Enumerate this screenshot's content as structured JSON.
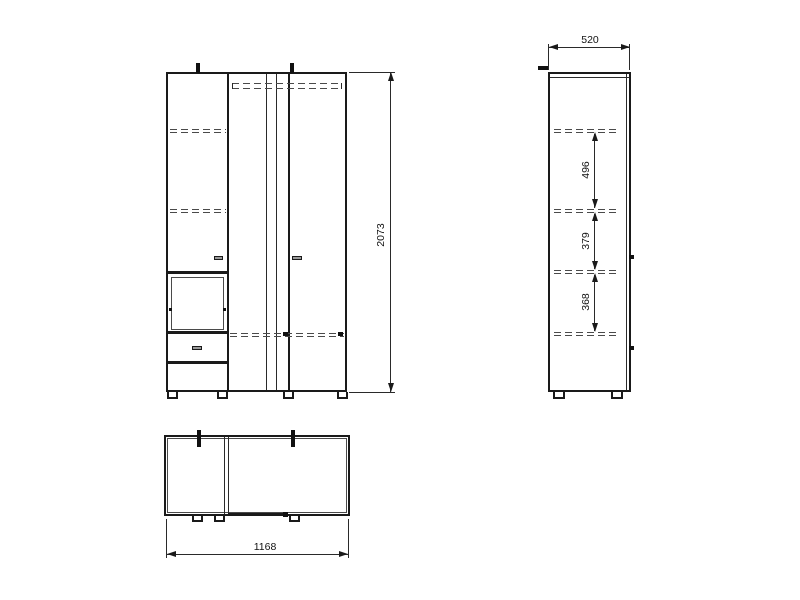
{
  "drawing": {
    "front": {
      "height_mm": "2073"
    },
    "side": {
      "depth_mm": "520",
      "gap_top_mm": "496",
      "gap_middle_mm": "379",
      "gap_bottom_mm": "368"
    },
    "top": {
      "width_mm": "1168"
    },
    "colors": {
      "line": "#1a1a1a",
      "dash": "#4a4a4a",
      "background": "#ffffff"
    }
  }
}
